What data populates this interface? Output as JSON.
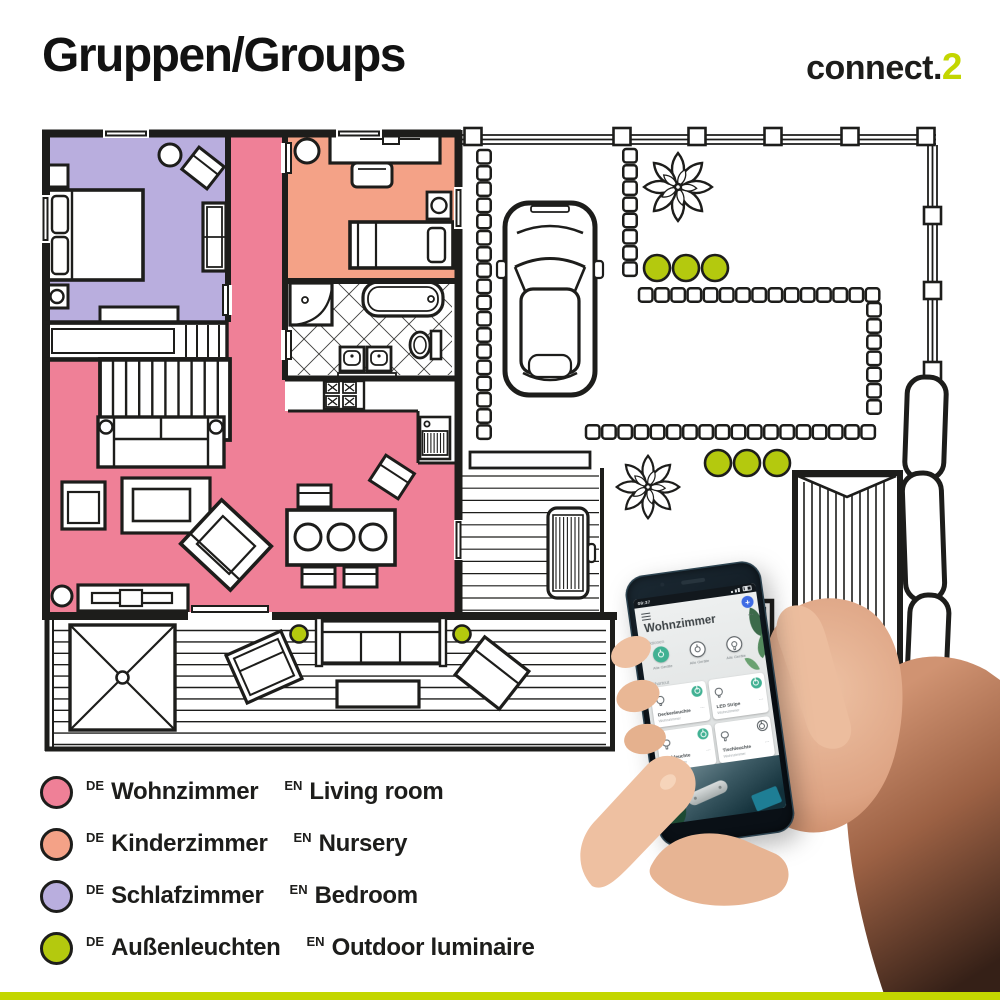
{
  "header": {
    "title": "Gruppen/Groups",
    "brand": "connect.",
    "brand_accent": "2"
  },
  "colors": {
    "accent_green": "#c3d600",
    "room_living": "#ef8097",
    "room_nursery": "#f4a287",
    "room_bedroom": "#b9aede",
    "outdoor_dot": "#b4c90e",
    "ink": "#1d1d1b",
    "app_teal": "#41b193",
    "fab_blue": "#3e6be4"
  },
  "legend": {
    "items": [
      {
        "tag_de": "DE",
        "name_de": "Wohnzimmer",
        "tag_en": "EN",
        "name_en": "Living room",
        "color": "#ef8097"
      },
      {
        "tag_de": "DE",
        "name_de": "Kinderzimmer",
        "tag_en": "EN",
        "name_en": "Nursery",
        "color": "#f4a287"
      },
      {
        "tag_de": "DE",
        "name_de": "Schlafzimmer",
        "tag_en": "EN",
        "name_en": "Bedroom",
        "color": "#b9aede"
      },
      {
        "tag_de": "DE",
        "name_de": "Außenleuchten",
        "tag_en": "EN",
        "name_en": "Outdoor luminaire",
        "color": "#b4c90e"
      }
    ]
  },
  "phone": {
    "status_time": "09:37",
    "app": {
      "title": "Wohnzimmer",
      "fab_glyph": "+",
      "overflow_glyph": "⋯",
      "actions_label": "Aktionen",
      "actions": [
        {
          "label": "Alle Geräte"
        },
        {
          "label": "Alle Geräte"
        },
        {
          "label": "Alle Geräte"
        }
      ],
      "shortcut_label": "Shortcut",
      "cards": [
        {
          "title": "Deckenleuchte",
          "subtitle": "Wohnzimmer"
        },
        {
          "title": "LED Stripe",
          "subtitle": "Wohnzimmer"
        },
        {
          "title": "Stehleuchte",
          "subtitle": "Wohnzimmer"
        },
        {
          "title": "Tischleuchte",
          "subtitle": "Wohnzimmer"
        }
      ]
    }
  }
}
